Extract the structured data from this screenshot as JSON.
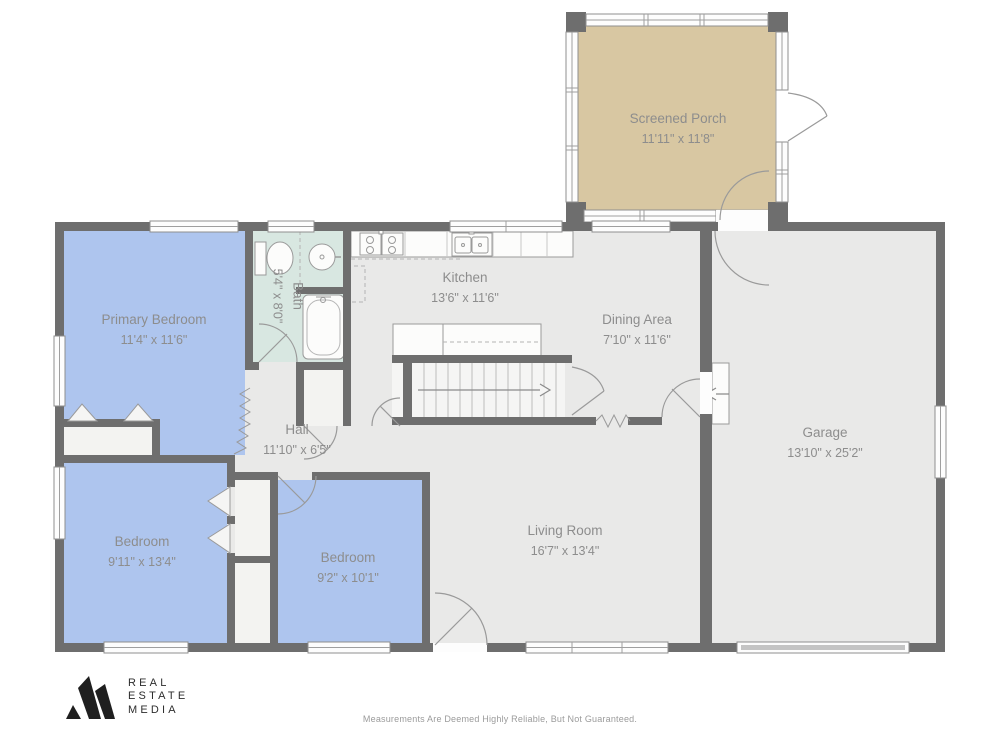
{
  "plan": {
    "rooms": {
      "screened_porch": {
        "name": "Screened Porch",
        "dims": "11'11\" x 11'8\""
      },
      "kitchen": {
        "name": "Kitchen",
        "dims": "13'6\" x 11'6\""
      },
      "dining_area": {
        "name": "Dining Area",
        "dims": "7'10\" x 11'6\""
      },
      "primary_bedroom": {
        "name": "Primary Bedroom",
        "dims": "11'4\" x 11'6\""
      },
      "bath": {
        "name": "Bath",
        "dims": "5'4\" x 8'0\""
      },
      "hall": {
        "name": "Hall",
        "dims": "11'10\" x 6'5\""
      },
      "bedroom_left": {
        "name": "Bedroom",
        "dims": "9'11\" x 13'4\""
      },
      "bedroom_right": {
        "name": "Bedroom",
        "dims": "9'2\" x 10'1\""
      },
      "living_room": {
        "name": "Living Room",
        "dims": "16'7\" x 13'4\""
      },
      "garage": {
        "name": "Garage",
        "dims": "13'10\" x 25'2\""
      }
    },
    "colors": {
      "wall": "#6e6e6e",
      "floor": "#e9e9e8",
      "bedroom_fill": "#aec5ee",
      "porch_fill": "#d8c7a2",
      "bath_fill": "#d8e7e1",
      "label_text": "#8d8d8d"
    }
  },
  "footer": {
    "logo_lines": [
      "REAL",
      "ESTATE",
      "MEDIA"
    ],
    "disclaimer": "Measurements Are Deemed Highly Reliable, But Not Guaranteed."
  }
}
